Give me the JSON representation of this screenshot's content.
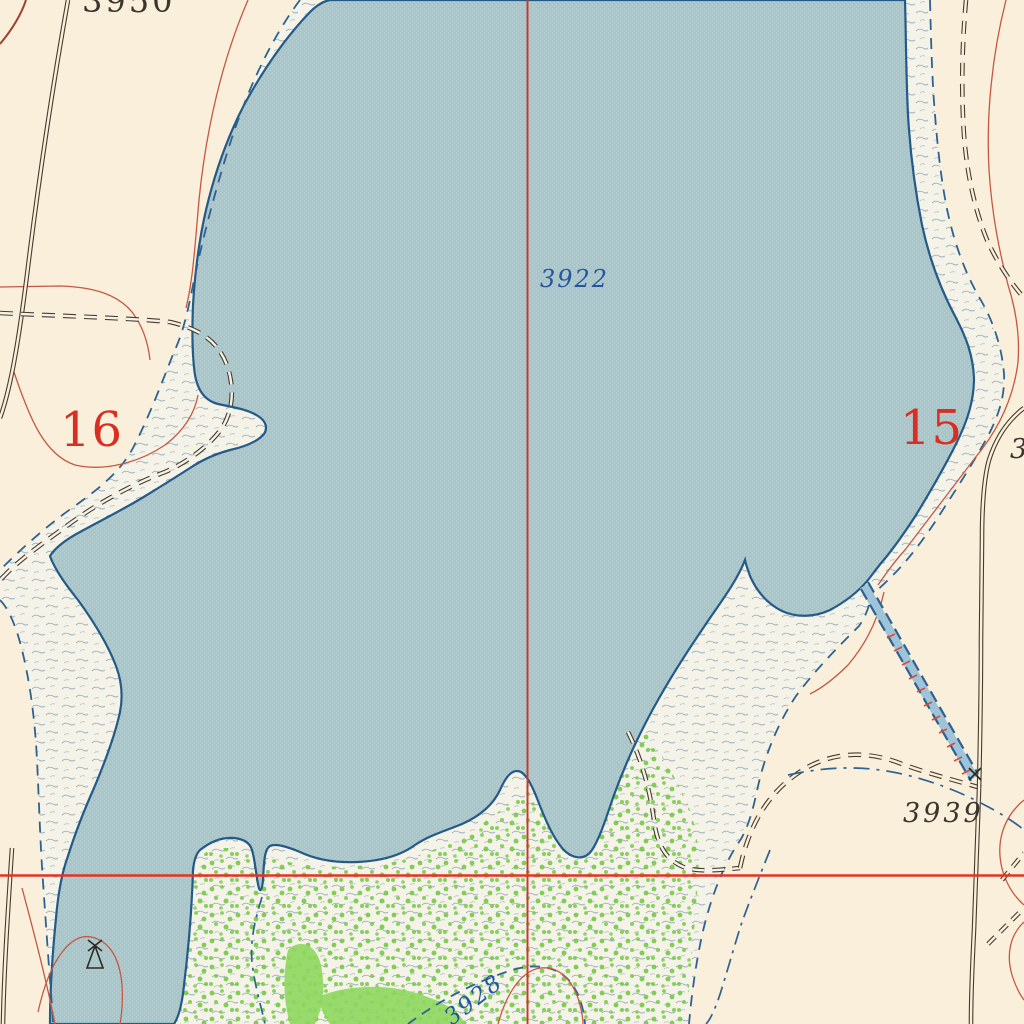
{
  "map": {
    "region_labels": {
      "section_left": {
        "text": "16"
      },
      "section_right": {
        "text": "15"
      }
    },
    "elevation_labels": {
      "contour_top": {
        "text": "3950"
      },
      "water_surface": {
        "text": "3922"
      },
      "spot_southeast": {
        "text": "3939"
      },
      "contour_bottom": {
        "text": "3928"
      },
      "partial_right_edge": {
        "text": "3"
      }
    },
    "colors": {
      "land": "#f9efda",
      "lake": "#a9c6cb",
      "marsh": "#f5f3e8",
      "shoreline": "#235a88",
      "stream": "#2e6290",
      "section_line_vertical": "#c63b2c",
      "section_line_horizontal": "#e33325",
      "contour": "#c65843",
      "road": "#463b2e",
      "section_number": "#d92f23",
      "water_label": "#2456a0",
      "spot_label": "#3b352d",
      "vegetation": "#76ca45",
      "canal_hachure": "#d84b35"
    },
    "features": [
      "lake",
      "marsh-band",
      "intermittent-stream",
      "canal-levee",
      "unimproved-road",
      "trail",
      "section-line",
      "contour-line",
      "vegetation",
      "windmill"
    ]
  }
}
